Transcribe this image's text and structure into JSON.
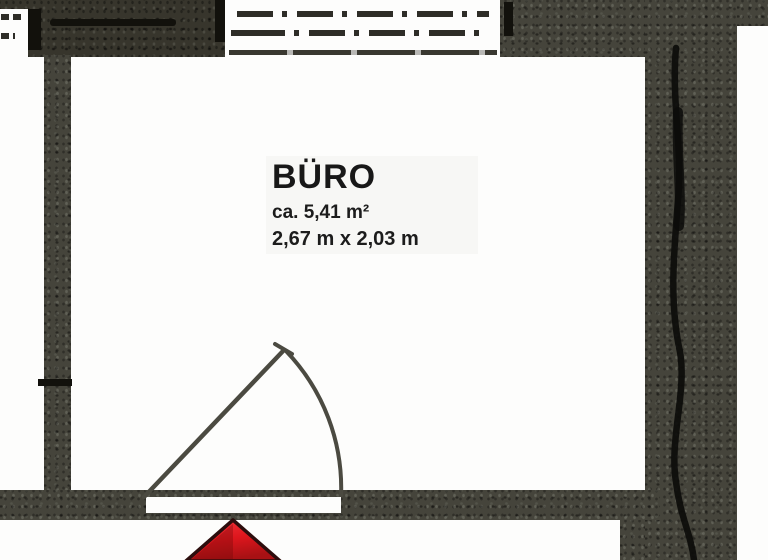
{
  "floorplan": {
    "room": {
      "name": "BÜRO",
      "area": "ca. 5,41 m²",
      "dimensions": "2,67 m x 2,03 m"
    },
    "icons": {
      "entrance_arrow": "red-up-arrow-entrance-marker",
      "door_swing": "quarter-circle-door-swing"
    },
    "colors": {
      "wall_fill": "#45443B",
      "wall_fill_dark": "#37352C",
      "paper": "#FDFDFC",
      "linework": "#4B4A41",
      "black_accent": "#12110C",
      "arrow_red": "#E3161D",
      "arrow_red_dark": "#A31114",
      "text": "#181818"
    }
  }
}
